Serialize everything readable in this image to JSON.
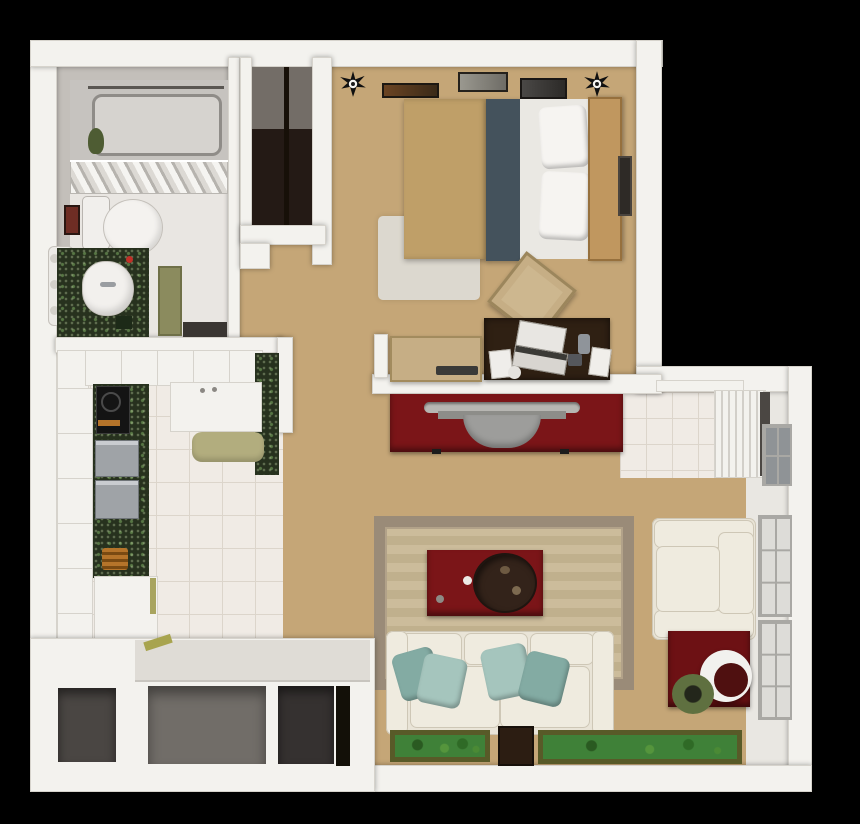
{
  "title": "3D top-down floor plan of a studio apartment",
  "palette": {
    "bg": "#000000",
    "wall": "#f3f2ee",
    "wallEdge": "#d6d3cc",
    "wallFace": "#c3bfba",
    "floorTan": "#c5a677",
    "bathFloor": "#e9e6e2",
    "tile": "#f0ebe5",
    "tileLine": "#dcd5cb",
    "counterGreen": "#27311e",
    "cream": "#e9e4d7",
    "creamLight": "#efebdf",
    "creamEdge": "#cec7b6",
    "teal1": "#a5c5bd",
    "teal2": "#83aba3",
    "redFurn": "#7b1518",
    "redDark": "#6d1114",
    "trayBrown": "#33231a",
    "deskBrown": "#2f2013",
    "wood": "#c0975f",
    "blanketTan": "#bf9f68",
    "bedStripe": "#44525c",
    "sheetWhite": "#eae8e3",
    "rugBorder": "#9a8b78",
    "matGreen": "#3f8138",
    "matBorder": "#585a28",
    "steel": "#9fa3a7",
    "oliveDoor": "#8b8b5e",
    "oliveMat": "#b2ad7e",
    "paneLight": "#dddcd8",
    "paneFrame": "#a9a8a4",
    "closetDark": "#241a15",
    "stoveBlack": "#141414",
    "tubGray": "#c6c3bf"
  },
  "rooms": [
    {
      "id": "bathroom",
      "name": "bathroom"
    },
    {
      "id": "closet",
      "name": "wardrobe closet"
    },
    {
      "id": "bedroom",
      "name": "bedroom"
    },
    {
      "id": "kitchen",
      "name": "kitchen"
    },
    {
      "id": "hallway",
      "name": "hallway"
    },
    {
      "id": "living-room",
      "name": "living room"
    },
    {
      "id": "storage",
      "name": "storage closet"
    }
  ],
  "furniture": {
    "bathroom": [
      "bathtub",
      "towel-rack",
      "toilet",
      "sink-vanity",
      "radiator",
      "wall-art",
      "door"
    ],
    "bedroom": [
      "double-bed",
      "pillows",
      "headboard",
      "wall-pictures",
      "ceiling-lights",
      "desk",
      "laptop",
      "desk-chair",
      "nightstand",
      "remote",
      "bedside-rug",
      "wall-picture-right"
    ],
    "kitchen": [
      "upper-cabinets",
      "sink-unit",
      "granite-counter",
      "stove",
      "steel-appliances",
      "basket",
      "island-cart",
      "tall-cabinets",
      "floor-mat",
      "breakfast-bar"
    ],
    "living-room": [
      "tv-stand",
      "tv",
      "area-rug",
      "coffee-table",
      "serving-tray",
      "sofa",
      "throw-pillows",
      "armchair",
      "side-table",
      "bowl-lamp",
      "wreath",
      "floor-mats",
      "stool",
      "windows",
      "louvered-cabinet"
    ]
  }
}
